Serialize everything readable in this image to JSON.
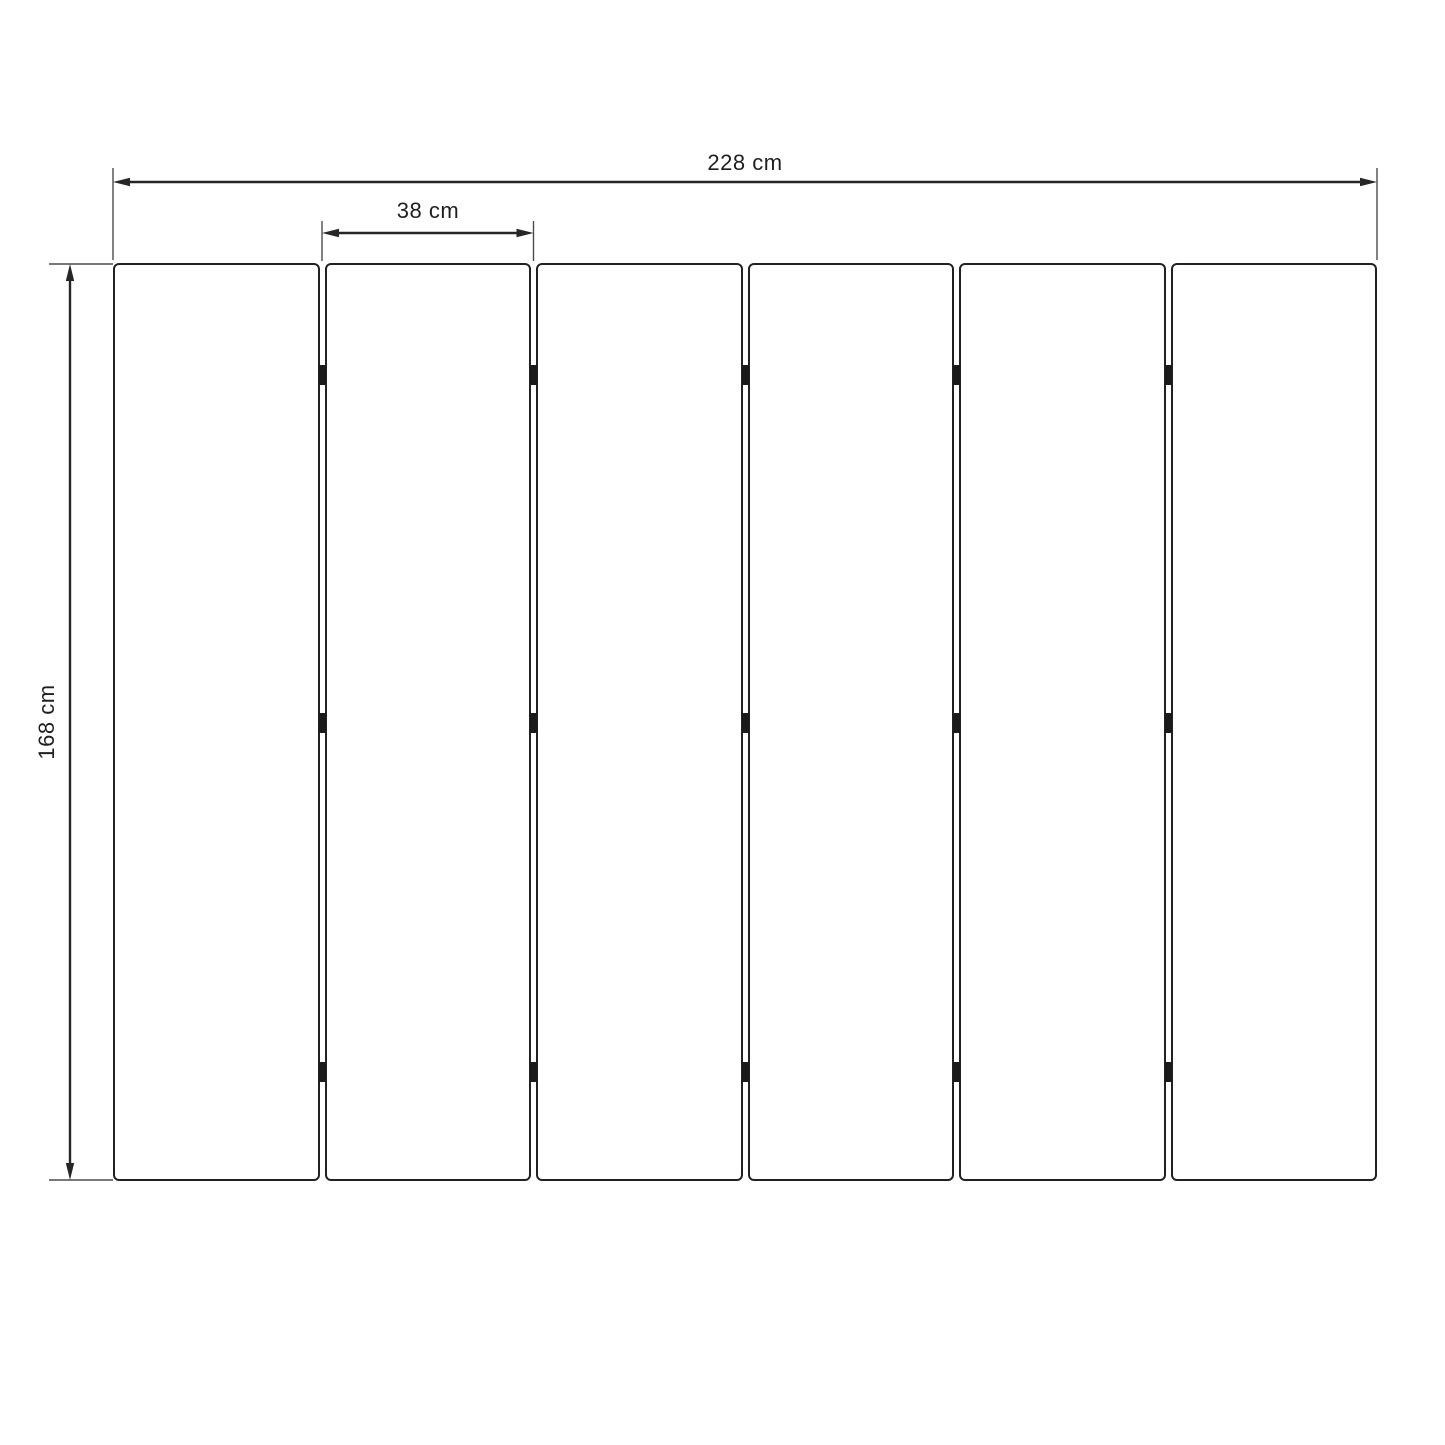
{
  "diagram": {
    "panels": {
      "count": 6,
      "hinge_rows": 3
    },
    "dimensions": {
      "total_width": {
        "label": "228 cm",
        "value": 228,
        "unit": "cm"
      },
      "panel_pitch": {
        "label": "38 cm",
        "value": 38,
        "unit": "cm"
      },
      "height": {
        "label": "168 cm",
        "value": 168,
        "unit": "cm"
      }
    },
    "colors": {
      "line": "#262626",
      "extension_line": "#4d4d4d",
      "panel_border": "#212121",
      "hinge": "#1a1a1a",
      "text": "#1f1f1f",
      "background": "#ffffff"
    }
  }
}
